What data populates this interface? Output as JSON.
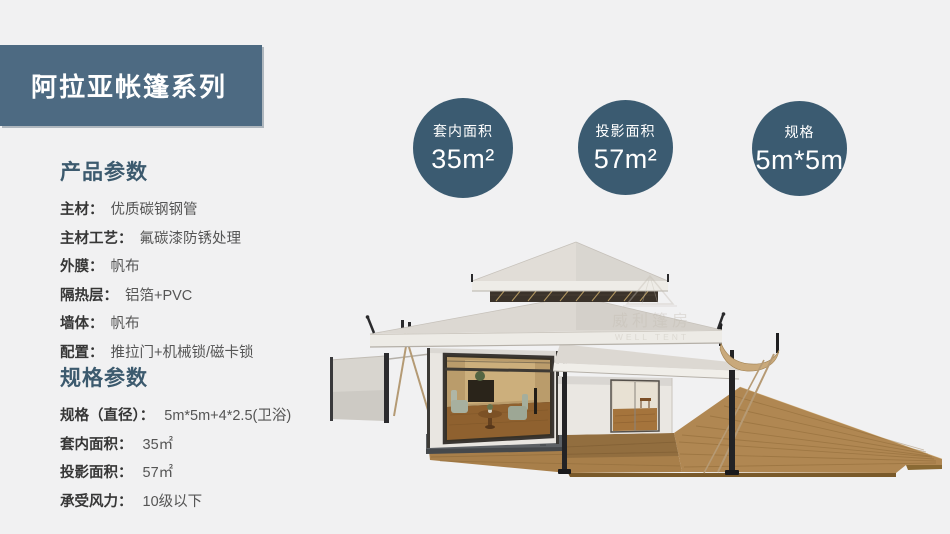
{
  "banner": {
    "title": "阿拉亚帐篷系列"
  },
  "sections": {
    "product": {
      "heading": "产品参数",
      "rows": [
        {
          "label": "主材：",
          "value": "优质碳钢钢管"
        },
        {
          "label": "主材工艺：",
          "value": "氟碳漆防锈处理"
        },
        {
          "label": "外膜：",
          "value": "帆布"
        },
        {
          "label": "隔热层：",
          "value": "铝箔+PVC"
        },
        {
          "label": "墙体：",
          "value": "帆布"
        },
        {
          "label": "配置：",
          "value": "推拉门+机械锁/磁卡锁"
        }
      ]
    },
    "spec": {
      "heading": "规格参数",
      "rows": [
        {
          "label": "规格（直径）：",
          "value": "5m*5m+4*2.5(卫浴)"
        },
        {
          "label": "套内面积：",
          "value": "35㎡"
        },
        {
          "label": "投影面积：",
          "value": "57㎡"
        },
        {
          "label": "承受风力：",
          "value": "10级以下"
        }
      ]
    }
  },
  "badges": {
    "inner_area": {
      "label": "套内面积",
      "value": "35m²"
    },
    "projection_area": {
      "label": "投影面积",
      "value": "57m²"
    },
    "size": {
      "label": "规格",
      "value": "5m*5m"
    }
  },
  "watermark": {
    "cn": "威利篷房",
    "en": "WELL TENT"
  },
  "colors": {
    "banner_bg": "#4d6a82",
    "badge_bg": "#3b5b71",
    "heading": "#3c5a6e",
    "background": "#f1f1f2"
  }
}
